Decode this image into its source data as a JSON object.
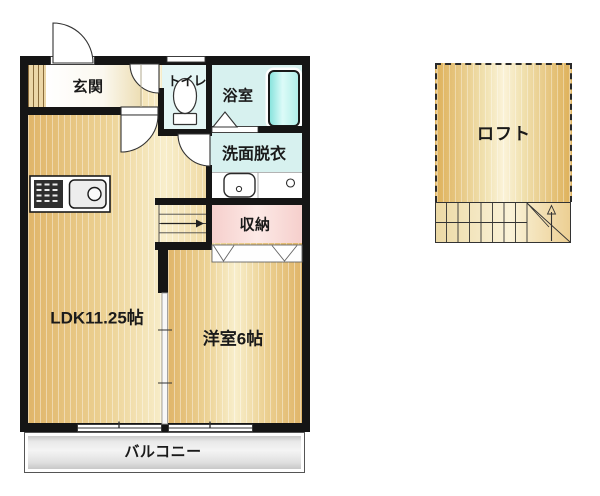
{
  "plan": {
    "type": "apartment-floor-plan",
    "rooms": {
      "genkan": {
        "label": "玄関"
      },
      "toilet": {
        "label": "トイレ"
      },
      "bathroom": {
        "label": "浴室"
      },
      "washroom": {
        "label": "洗面脱衣"
      },
      "storage": {
        "label": "収納"
      },
      "ldk": {
        "label": "LDK11.25帖"
      },
      "western_room": {
        "label": "洋室6帖"
      },
      "balcony": {
        "label": "バルコニー"
      },
      "loft": {
        "label": "ロフト"
      }
    },
    "fixtures": [
      "entrance-door",
      "toilet",
      "bathtub",
      "bath-door-triangle",
      "vanity-sink",
      "washing-machine-outlet",
      "kitchen-stove",
      "kitchen-sink",
      "shoe-cabinet",
      "main-staircase",
      "loft-staircase",
      "closet-folding-doors",
      "sliding-partition"
    ],
    "colors": {
      "wall": "#151515",
      "floor_beige": "#ecd193",
      "wet_area_cyan": "#d7f1ef",
      "bathtub_cyan": "#8ae4de",
      "storage_pink": "#f6cfcc",
      "balcony_gray": "#e9e9e9"
    }
  }
}
